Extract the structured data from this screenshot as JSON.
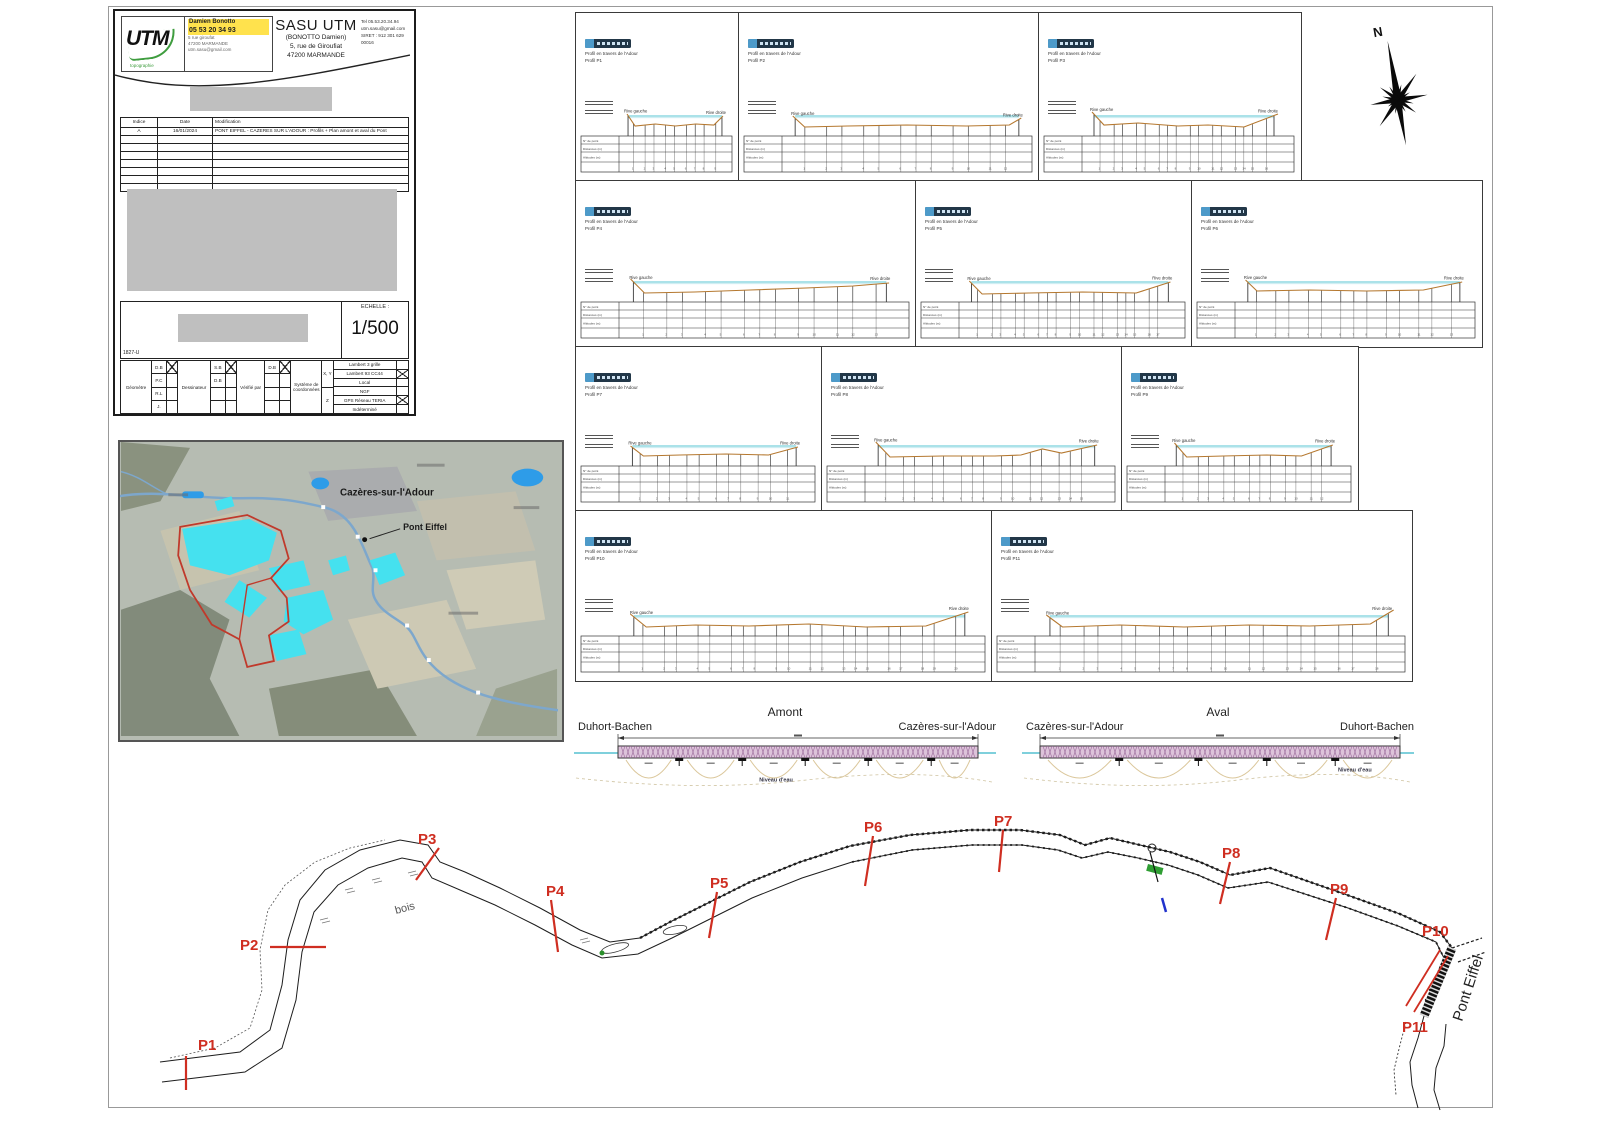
{
  "sheet": {
    "scale_label": "ECHELLE :",
    "scale_value": "1/500",
    "doc_ref": "1827-U"
  },
  "title_block": {
    "logo": {
      "brand": "UTM",
      "sub": "topographie"
    },
    "contact_card": {
      "line1": "Damien Bonotto",
      "line2": "05 53 20 34 93",
      "line3": "5 rue giroufat",
      "line4": "47200 MARMANDE",
      "line5": "utm.sasu@gmail.com"
    },
    "company": {
      "name": "SASU UTM",
      "subtitle": "(BONOTTO Damien)",
      "address1": "5, rue de Giroufiat",
      "address2": "47200 MARMANDE"
    },
    "contact_right": {
      "tel": "Tel 05.53.20.34.94",
      "email": "utm.sasu@gmail.com",
      "siret": "SIRET : 912 301 629 00016"
    },
    "revisions": {
      "headers": [
        "Indice",
        "Date",
        "Modification"
      ],
      "row": [
        "A",
        "16/01/2024",
        "PONT EIFFEL - CAZERES SUR L'ADOUR : Profils + Plan amont et aval du Pont"
      ],
      "empty_rows": 7
    },
    "approval": {
      "col1": "Géomètre",
      "col1_cells": [
        "D.B",
        "P.C",
        "R.L",
        "J."
      ],
      "col2": "Dessinateur",
      "col2_cells": [
        "S.B",
        "D.B",
        "",
        ""
      ],
      "col3": "Vérifié par",
      "col3_cells": [
        "D.B",
        "",
        "",
        ""
      ],
      "col4": "Système de coordonnées",
      "xy": "X, Y",
      "z": "Z",
      "options": [
        "Lambert 3 grille",
        "Lambert 93 CC44",
        "Local",
        "NGF",
        "GPS Réseau TERIA",
        "Indéterminé"
      ],
      "options_checked": [
        1,
        4
      ]
    }
  },
  "map": {
    "town": "Cazères-sur-l'Adour",
    "bridge": "Pont Eiffel"
  },
  "compass": {
    "label": "N"
  },
  "profiles": {
    "rive_gauche": "Rive gauche",
    "rive_droite": "Rive droite",
    "table_labels": [
      "N° de point",
      "Distances (m)",
      "Altitudes (m)"
    ],
    "panels": [
      {
        "id": "P1",
        "x": 575,
        "y": 12,
        "w": 163,
        "h": 168,
        "t1": "Profil en travers de l'Adour",
        "t2": "Profil P1",
        "water": [
          0.03,
          0.96
        ],
        "ticks": 9,
        "ground": [
          [
            0.02,
            22
          ],
          [
            0.1,
            10
          ],
          [
            0.3,
            12
          ],
          [
            0.5,
            10
          ],
          [
            0.7,
            12
          ],
          [
            0.88,
            11
          ],
          [
            0.97,
            20
          ]
        ]
      },
      {
        "id": "P2",
        "x": 738,
        "y": 12,
        "w": 300,
        "h": 168,
        "t1": "Profil en travers de l'Adour",
        "t2": "Profil P2",
        "water": [
          0.03,
          0.97
        ],
        "ticks": 12,
        "ground": [
          [
            0.02,
            20
          ],
          [
            0.07,
            9
          ],
          [
            0.25,
            10
          ],
          [
            0.5,
            11
          ],
          [
            0.75,
            10
          ],
          [
            0.93,
            11
          ],
          [
            0.98,
            18
          ]
        ]
      },
      {
        "id": "P3",
        "x": 1038,
        "y": 12,
        "w": 262,
        "h": 168,
        "t1": "Profil en travers de l'Adour",
        "t2": "Profil P3",
        "water": [
          0.03,
          0.93
        ],
        "ticks": 16,
        "ground": [
          [
            0.02,
            24
          ],
          [
            0.08,
            11
          ],
          [
            0.25,
            13
          ],
          [
            0.45,
            10
          ],
          [
            0.6,
            11
          ],
          [
            0.78,
            9
          ],
          [
            0.95,
            22
          ]
        ]
      },
      {
        "id": "P4",
        "x": 575,
        "y": 180,
        "w": 340,
        "h": 166,
        "t1": "Profil en travers de l'Adour",
        "t2": "Profil P4",
        "water": [
          0.03,
          0.94
        ],
        "ticks": 13,
        "ground": [
          [
            0.02,
            23
          ],
          [
            0.07,
            9
          ],
          [
            0.25,
            10
          ],
          [
            0.45,
            12
          ],
          [
            0.65,
            14
          ],
          [
            0.82,
            16
          ],
          [
            0.95,
            19
          ]
        ]
      },
      {
        "id": "P5",
        "x": 915,
        "y": 180,
        "w": 276,
        "h": 166,
        "t1": "Profil en travers de l'Adour",
        "t2": "Profil P5",
        "water": [
          0.03,
          0.95
        ],
        "ticks": 17,
        "ground": [
          [
            0.02,
            21
          ],
          [
            0.08,
            8
          ],
          [
            0.3,
            9
          ],
          [
            0.55,
            10
          ],
          [
            0.8,
            9
          ],
          [
            0.96,
            20
          ]
        ]
      },
      {
        "id": "P6",
        "x": 1191,
        "y": 180,
        "w": 290,
        "h": 166,
        "t1": "Profil en travers de l'Adour",
        "t2": "Profil P6",
        "water": [
          0.03,
          0.96
        ],
        "ticks": 13,
        "ground": [
          [
            0.02,
            22
          ],
          [
            0.07,
            11
          ],
          [
            0.3,
            12
          ],
          [
            0.55,
            11
          ],
          [
            0.8,
            12
          ],
          [
            0.97,
            20
          ]
        ]
      },
      {
        "id": "P7",
        "x": 575,
        "y": 346,
        "w": 246,
        "h": 164,
        "t1": "Profil en travers de l'Adour",
        "t2": "Profil P7",
        "water": [
          0.04,
          0.93
        ],
        "ticks": 11,
        "ground": [
          [
            0.03,
            20
          ],
          [
            0.1,
            10
          ],
          [
            0.3,
            11
          ],
          [
            0.55,
            12
          ],
          [
            0.78,
            11
          ],
          [
            0.94,
            19
          ]
        ]
      },
      {
        "id": "P8",
        "x": 821,
        "y": 346,
        "w": 300,
        "h": 164,
        "t1": "Profil en travers de l'Adour",
        "t2": "Profil P8",
        "water": [
          0.03,
          0.94
        ],
        "ticks": 15,
        "ground": [
          [
            0.02,
            24
          ],
          [
            0.08,
            9
          ],
          [
            0.3,
            10
          ],
          [
            0.52,
            10
          ],
          [
            0.63,
            11
          ],
          [
            0.72,
            17
          ],
          [
            0.8,
            13
          ],
          [
            0.95,
            21
          ]
        ]
      },
      {
        "id": "P9",
        "x": 1121,
        "y": 346,
        "w": 236,
        "h": 164,
        "t1": "Profil en travers de l'Adour",
        "t2": "Profil P9",
        "water": [
          0.03,
          0.92
        ],
        "ticks": 12,
        "ground": [
          [
            0.02,
            23
          ],
          [
            0.09,
            9
          ],
          [
            0.3,
            10
          ],
          [
            0.55,
            11
          ],
          [
            0.75,
            10
          ],
          [
            0.93,
            21
          ]
        ]
      },
      {
        "id": "P10",
        "x": 575,
        "y": 510,
        "w": 416,
        "h": 170,
        "t1": "Profil en travers de l'Adour",
        "t2": "Profil P10",
        "water": [
          0.025,
          0.96
        ],
        "ticks": 20,
        "ground": [
          [
            0.015,
            22
          ],
          [
            0.06,
            9
          ],
          [
            0.2,
            11
          ],
          [
            0.35,
            10
          ],
          [
            0.52,
            12
          ],
          [
            0.68,
            9
          ],
          [
            0.85,
            10
          ],
          [
            0.97,
            24
          ]
        ]
      },
      {
        "id": "P11",
        "x": 991,
        "y": 510,
        "w": 420,
        "h": 170,
        "t1": "Profil en travers de l'Adour",
        "t2": "Profil P11",
        "water": [
          0.025,
          0.97
        ],
        "ticks": 18,
        "ground": [
          [
            0.015,
            21
          ],
          [
            0.06,
            9
          ],
          [
            0.22,
            11
          ],
          [
            0.4,
            9
          ],
          [
            0.58,
            11
          ],
          [
            0.75,
            10
          ],
          [
            0.92,
            12
          ],
          [
            0.985,
            26
          ]
        ]
      }
    ]
  },
  "elevations": {
    "water_label": "Niveau d'eau",
    "views": [
      {
        "id": "amont",
        "title": "Amont",
        "left": "Duhort-Bachen",
        "right": "Cazères-sur-l'Adour",
        "x": 570,
        "y": 700,
        "w": 430,
        "h": 102,
        "deck": [
          48,
          408
        ],
        "caps": [
          0.17,
          0.345,
          0.52,
          0.695,
          0.87
        ],
        "wlx": 0.44,
        "wly": 0.8
      },
      {
        "id": "aval",
        "title": "Aval",
        "left": "Cazères-sur-l'Adour",
        "right": "Duhort-Bachen",
        "x": 1018,
        "y": 700,
        "w": 400,
        "h": 102,
        "deck": [
          22,
          382
        ],
        "caps": [
          0.22,
          0.44,
          0.63,
          0.82
        ],
        "wlx": 0.8,
        "wly": 0.7
      }
    ]
  },
  "plan": {
    "x": 110,
    "y": 790,
    "w": 1390,
    "h": 322,
    "red": "#cf2e21",
    "bois": "bois",
    "bridge_label": "Pont Eiffel",
    "bankA": [
      [
        50,
        272
      ],
      [
        130,
        262
      ],
      [
        160,
        240
      ],
      [
        172,
        195
      ],
      [
        178,
        150
      ],
      [
        190,
        110
      ],
      [
        215,
        80
      ],
      [
        250,
        60
      ],
      [
        290,
        50
      ],
      [
        318,
        55
      ],
      [
        330,
        72
      ],
      [
        355,
        82
      ],
      [
        390,
        98
      ],
      [
        430,
        118
      ],
      [
        470,
        140
      ],
      [
        500,
        152
      ],
      [
        530,
        148
      ],
      [
        560,
        132
      ],
      [
        600,
        112
      ],
      [
        640,
        92
      ],
      [
        690,
        72
      ],
      [
        740,
        56
      ],
      [
        800,
        45
      ],
      [
        860,
        40
      ],
      [
        910,
        40
      ],
      [
        950,
        45
      ],
      [
        975,
        55
      ],
      [
        1000,
        48
      ],
      [
        1030,
        55
      ],
      [
        1060,
        62
      ],
      [
        1090,
        72
      ],
      [
        1120,
        85
      ],
      [
        1160,
        78
      ],
      [
        1200,
        92
      ],
      [
        1240,
        106
      ],
      [
        1290,
        124
      ],
      [
        1330,
        142
      ],
      [
        1342,
        158
      ]
    ],
    "bankB": [
      [
        52,
        292
      ],
      [
        135,
        282
      ],
      [
        172,
        258
      ],
      [
        186,
        210
      ],
      [
        192,
        162
      ],
      [
        204,
        122
      ],
      [
        228,
        95
      ],
      [
        258,
        78
      ],
      [
        292,
        68
      ],
      [
        312,
        72
      ],
      [
        322,
        88
      ],
      [
        350,
        100
      ],
      [
        385,
        115
      ],
      [
        425,
        135
      ],
      [
        462,
        155
      ],
      [
        492,
        168
      ],
      [
        528,
        164
      ],
      [
        562,
        148
      ],
      [
        602,
        128
      ],
      [
        642,
        108
      ],
      [
        692,
        88
      ],
      [
        742,
        72
      ],
      [
        802,
        60
      ],
      [
        862,
        55
      ],
      [
        912,
        55
      ],
      [
        948,
        60
      ],
      [
        972,
        68
      ],
      [
        998,
        62
      ],
      [
        1028,
        68
      ],
      [
        1058,
        75
      ],
      [
        1088,
        85
      ],
      [
        1118,
        98
      ],
      [
        1158,
        92
      ],
      [
        1198,
        105
      ],
      [
        1238,
        118
      ],
      [
        1288,
        136
      ],
      [
        1326,
        152
      ],
      [
        1334,
        168
      ]
    ],
    "dotted": [
      [
        60,
        268
      ],
      [
        105,
        258
      ],
      [
        140,
        238
      ],
      [
        152,
        200
      ],
      [
        150,
        160
      ],
      [
        158,
        120
      ],
      [
        175,
        95
      ],
      [
        205,
        72
      ],
      [
        240,
        58
      ],
      [
        275,
        50
      ]
    ],
    "south": [
      [
        [
          1314,
          226
        ],
        [
          1308,
          248
        ],
        [
          1300,
          272
        ],
        [
          1302,
          295
        ],
        [
          1308,
          318
        ]
      ],
      [
        [
          1336,
          234
        ],
        [
          1334,
          256
        ],
        [
          1326,
          278
        ],
        [
          1324,
          300
        ],
        [
          1330,
          320
        ]
      ],
      [
        [
          1296,
          232
        ],
        [
          1290,
          255
        ],
        [
          1284,
          280
        ],
        [
          1286,
          305
        ]
      ]
    ],
    "stubs": [
      [
        [
          1342,
          158
        ],
        [
          1372,
          148
        ]
      ],
      [
        [
          1348,
          172
        ],
        [
          1376,
          162
        ]
      ]
    ],
    "bridge": [
      1342,
      158,
      1314,
      226
    ],
    "p10_lines": [
      [
        1330,
        160,
        1296,
        216
      ],
      [
        1338,
        166,
        1304,
        222
      ]
    ],
    "markers": [
      {
        "label": "P1",
        "lx": 88,
        "ly": 260,
        "tick": [
          76,
          266,
          76,
          300
        ]
      },
      {
        "label": "P2",
        "lx": 130,
        "ly": 160,
        "tick": [
          160,
          157,
          216,
          157
        ]
      },
      {
        "label": "P3",
        "lx": 308,
        "ly": 54,
        "tick": [
          306,
          90,
          329,
          58
        ]
      },
      {
        "label": "P4",
        "lx": 436,
        "ly": 106,
        "tick": [
          441,
          110,
          448,
          162
        ]
      },
      {
        "label": "P5",
        "lx": 600,
        "ly": 98,
        "tick": [
          607,
          102,
          599,
          148
        ]
      },
      {
        "label": "P6",
        "lx": 754,
        "ly": 42,
        "tick": [
          763,
          46,
          755,
          96
        ]
      },
      {
        "label": "P7",
        "lx": 884,
        "ly": 36,
        "tick": [
          893,
          40,
          889,
          82
        ]
      },
      {
        "label": "P8",
        "lx": 1112,
        "ly": 68,
        "tick": [
          1120,
          72,
          1110,
          114
        ]
      },
      {
        "label": "P9",
        "lx": 1220,
        "ly": 104,
        "tick": [
          1226,
          108,
          1216,
          150
        ]
      },
      {
        "label": "P10",
        "lx": 1312,
        "ly": 146
      },
      {
        "label": "P11",
        "lx": 1292,
        "ly": 242
      }
    ],
    "bois_pos": [
      286,
      124
    ],
    "bridge_text_pos": [
      1352,
      232
    ],
    "green_patch": [
      1038,
      74,
      16,
      7
    ],
    "green_dot": [
      492,
      163
    ],
    "blue_dash": [
      1052,
      108,
      1056,
      122
    ],
    "circle": [
      1042,
      58
    ],
    "struct_line": [
      1040,
      62,
      1048,
      92
    ],
    "islands": [
      [
        505,
        158,
        14,
        4,
        -15
      ],
      [
        565,
        140,
        12,
        4,
        -12
      ]
    ],
    "grass": [
      [
        235,
        100
      ],
      [
        262,
        90
      ],
      [
        298,
        83
      ],
      [
        210,
        130
      ],
      [
        470,
        150
      ]
    ],
    "dots": [
      [
        1320,
        200
      ],
      [
        1326,
        192
      ],
      [
        1316,
        210
      ]
    ]
  }
}
